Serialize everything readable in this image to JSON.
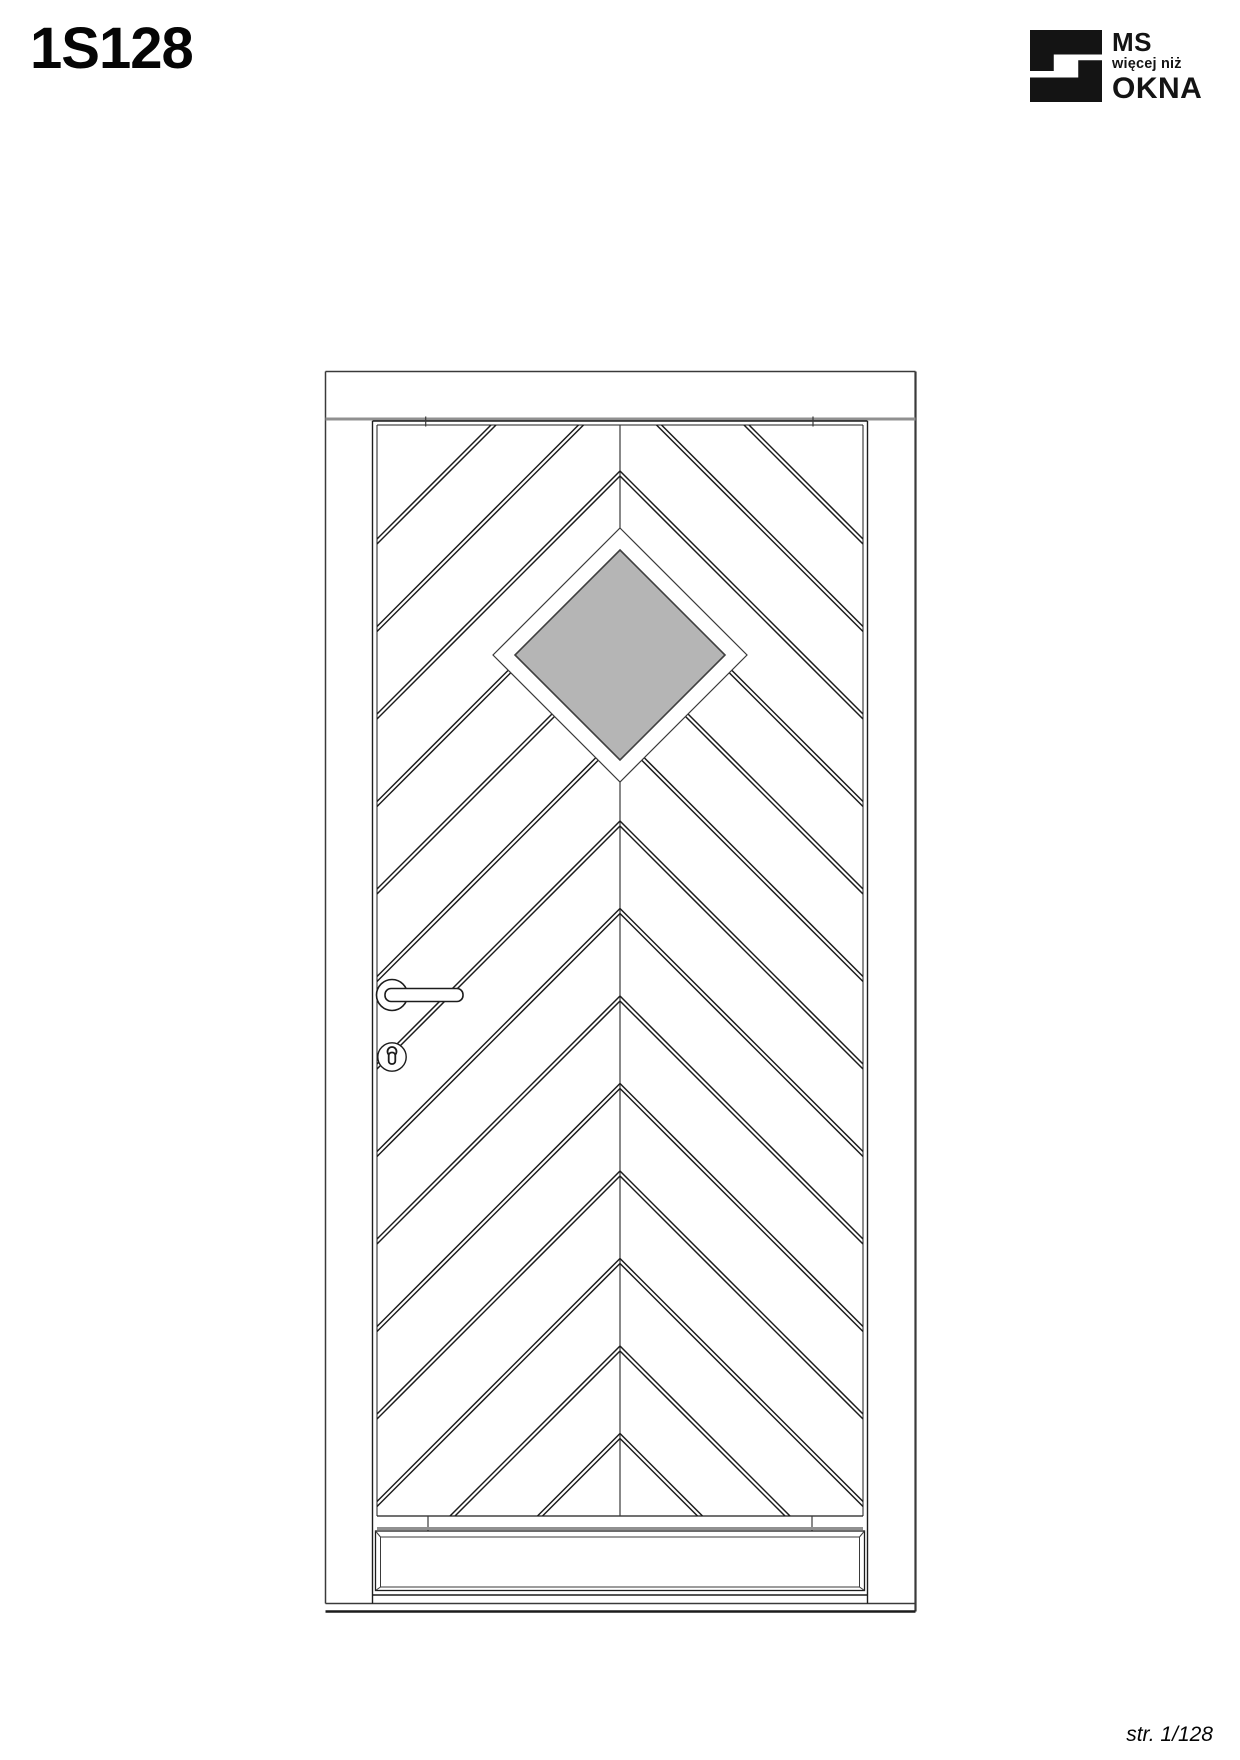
{
  "header": {
    "title": "1S128"
  },
  "logo": {
    "line1": "MS",
    "line2": "więcej niż",
    "line3": "OKNA",
    "icon": "ms-okna-logo-icon",
    "color": "#141414"
  },
  "footer": {
    "page_label": "str. 1/128"
  },
  "drawing": {
    "colors": {
      "line": "#1c1c1c",
      "thin": "#3a3a3a",
      "soft_gray": "#909090",
      "white": "#ffffff",
      "glass_fill": "#b5b5b5",
      "glass_stroke": "#404040"
    },
    "frame": {
      "x1": 325.5,
      "y1": 371.5,
      "x2": 915.5,
      "y2": 1611.5
    },
    "head_rail_y": 419,
    "threshold_y": 1603.5,
    "leaf": {
      "x1": 372.5,
      "y1": 421,
      "x2": 867.5,
      "y2": 1595,
      "side_bottom": 1603.5
    },
    "pattern": {
      "x1": 377,
      "y1": 425,
      "x2": 863,
      "y2": 1516,
      "center_x": 620,
      "seam_start": 916,
      "seam_step": 87.5,
      "seam_count": 14,
      "pair_gap": 5,
      "stroke_w": 1.5
    },
    "diamond": {
      "cx": 620,
      "cy": 655,
      "r_outer": 127,
      "r_glass": 105
    },
    "hinge_ticks_top": [
      425.7,
      813
    ],
    "panel_ticks": [
      428,
      812
    ],
    "panel": {
      "x1": 375.5,
      "y1": 1531,
      "x2": 864.5,
      "y2": 1590.5,
      "inset_side": 5,
      "inset_top": 6,
      "inset_bottom": 3.5,
      "gray_y": 1528.5
    },
    "handle": {
      "cx": 392,
      "cy": 995,
      "rosette_r": 15.5,
      "bar_x2": 463,
      "bar_h": 13,
      "esc_cy": 1057,
      "esc_r": 14.2,
      "key_r": 4.5,
      "key_stem_w": 6.6,
      "key_stem_h": 11.5
    }
  }
}
